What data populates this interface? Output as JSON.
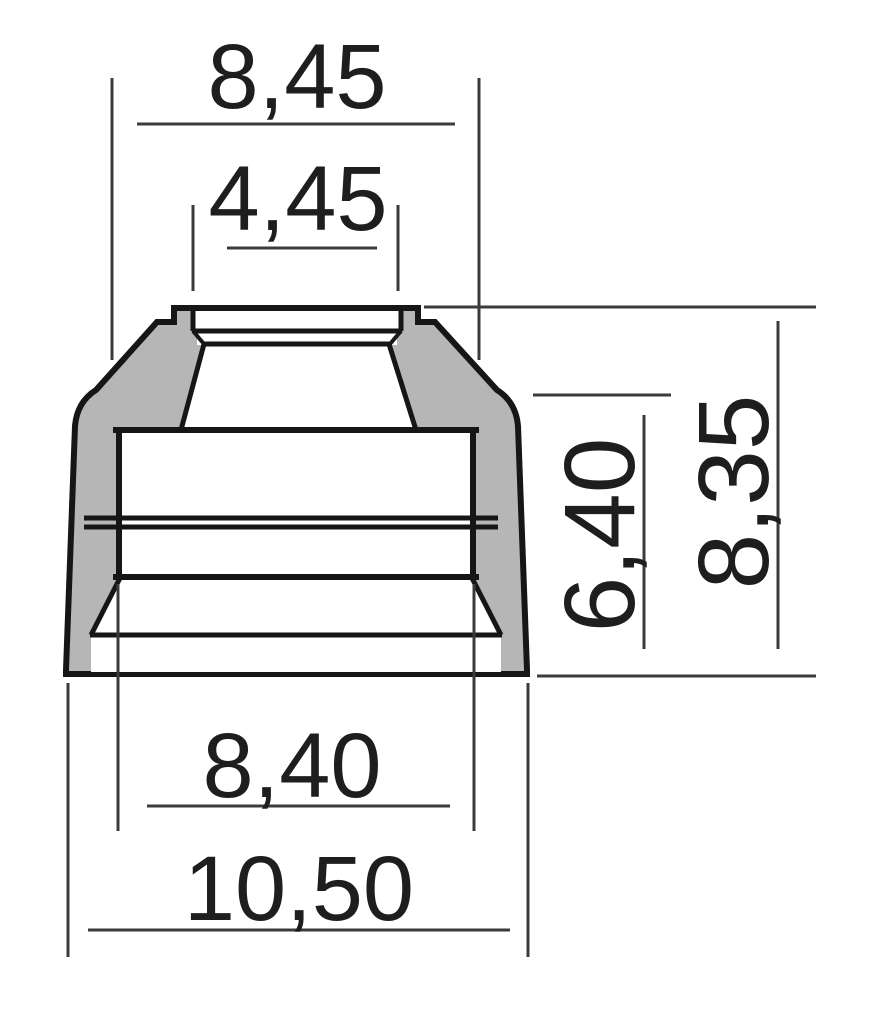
{
  "drawing": {
    "kind": "technical-cross-section",
    "colors": {
      "part-fill": "#b6b6b6",
      "part-outline": "#161616",
      "dim-line": "#3b3b3b",
      "dim-text": "#1e1e1e",
      "canvas-bg": "#ffffff"
    }
  },
  "dimensions": {
    "top_outer_diameter": {
      "label": "8,45",
      "orientation": "horizontal"
    },
    "lip_inner_diameter": {
      "label": "4,45",
      "orientation": "horizontal"
    },
    "body_height": {
      "label": "6,40",
      "orientation": "vertical"
    },
    "total_height": {
      "label": "8,35",
      "orientation": "vertical"
    },
    "lower_inner_diameter": {
      "label": "8,40",
      "orientation": "horizontal"
    },
    "base_outer_diameter": {
      "label": "10,50",
      "orientation": "horizontal"
    }
  }
}
